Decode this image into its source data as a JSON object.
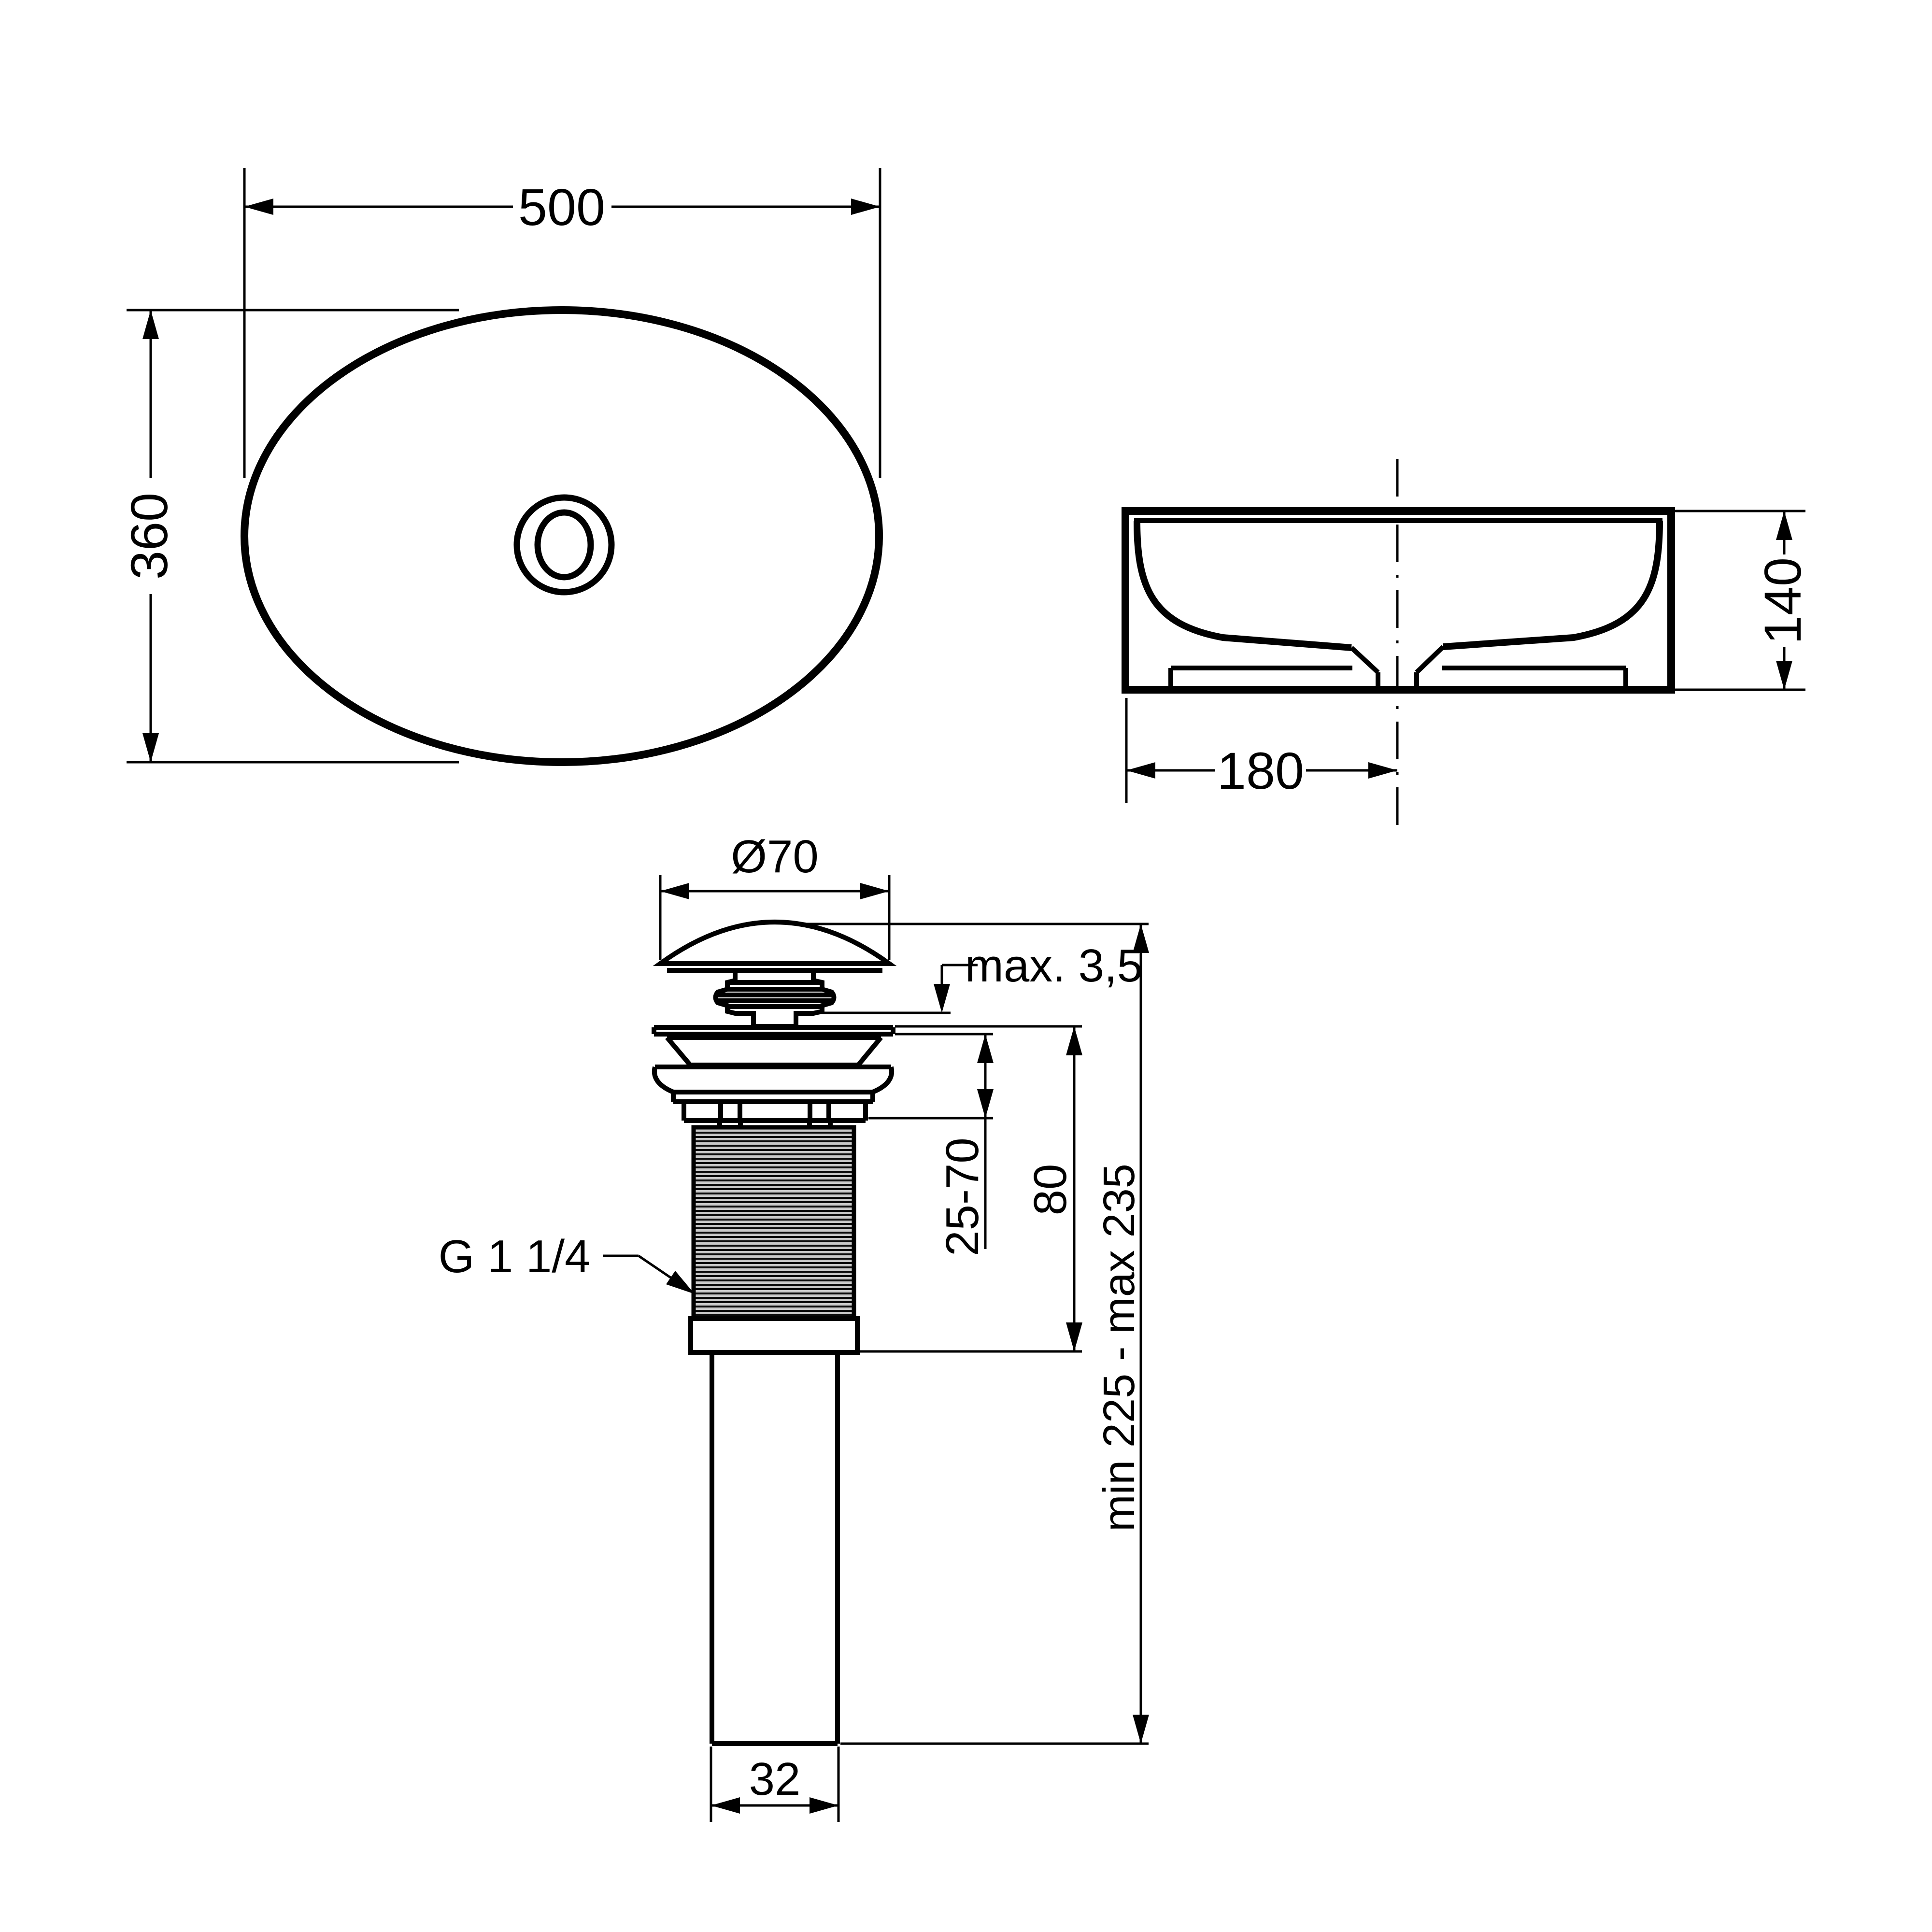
{
  "page": {
    "background": "#ffffff",
    "line_color": "#000000",
    "kind": "washbasin and pop-up waste technical dimension drawing"
  },
  "top_view": {
    "width": "500",
    "height": "360"
  },
  "side_view": {
    "height": "140",
    "drain_offset": "180"
  },
  "drain": {
    "cap_diameter": "Ø70",
    "cap_protrusion": "max. 3,5",
    "clamping_range": "25-70",
    "body_height": "80",
    "thread": "G 1 1/4",
    "installed_length": "min 225 - max 235",
    "pipe_diameter": "32"
  }
}
